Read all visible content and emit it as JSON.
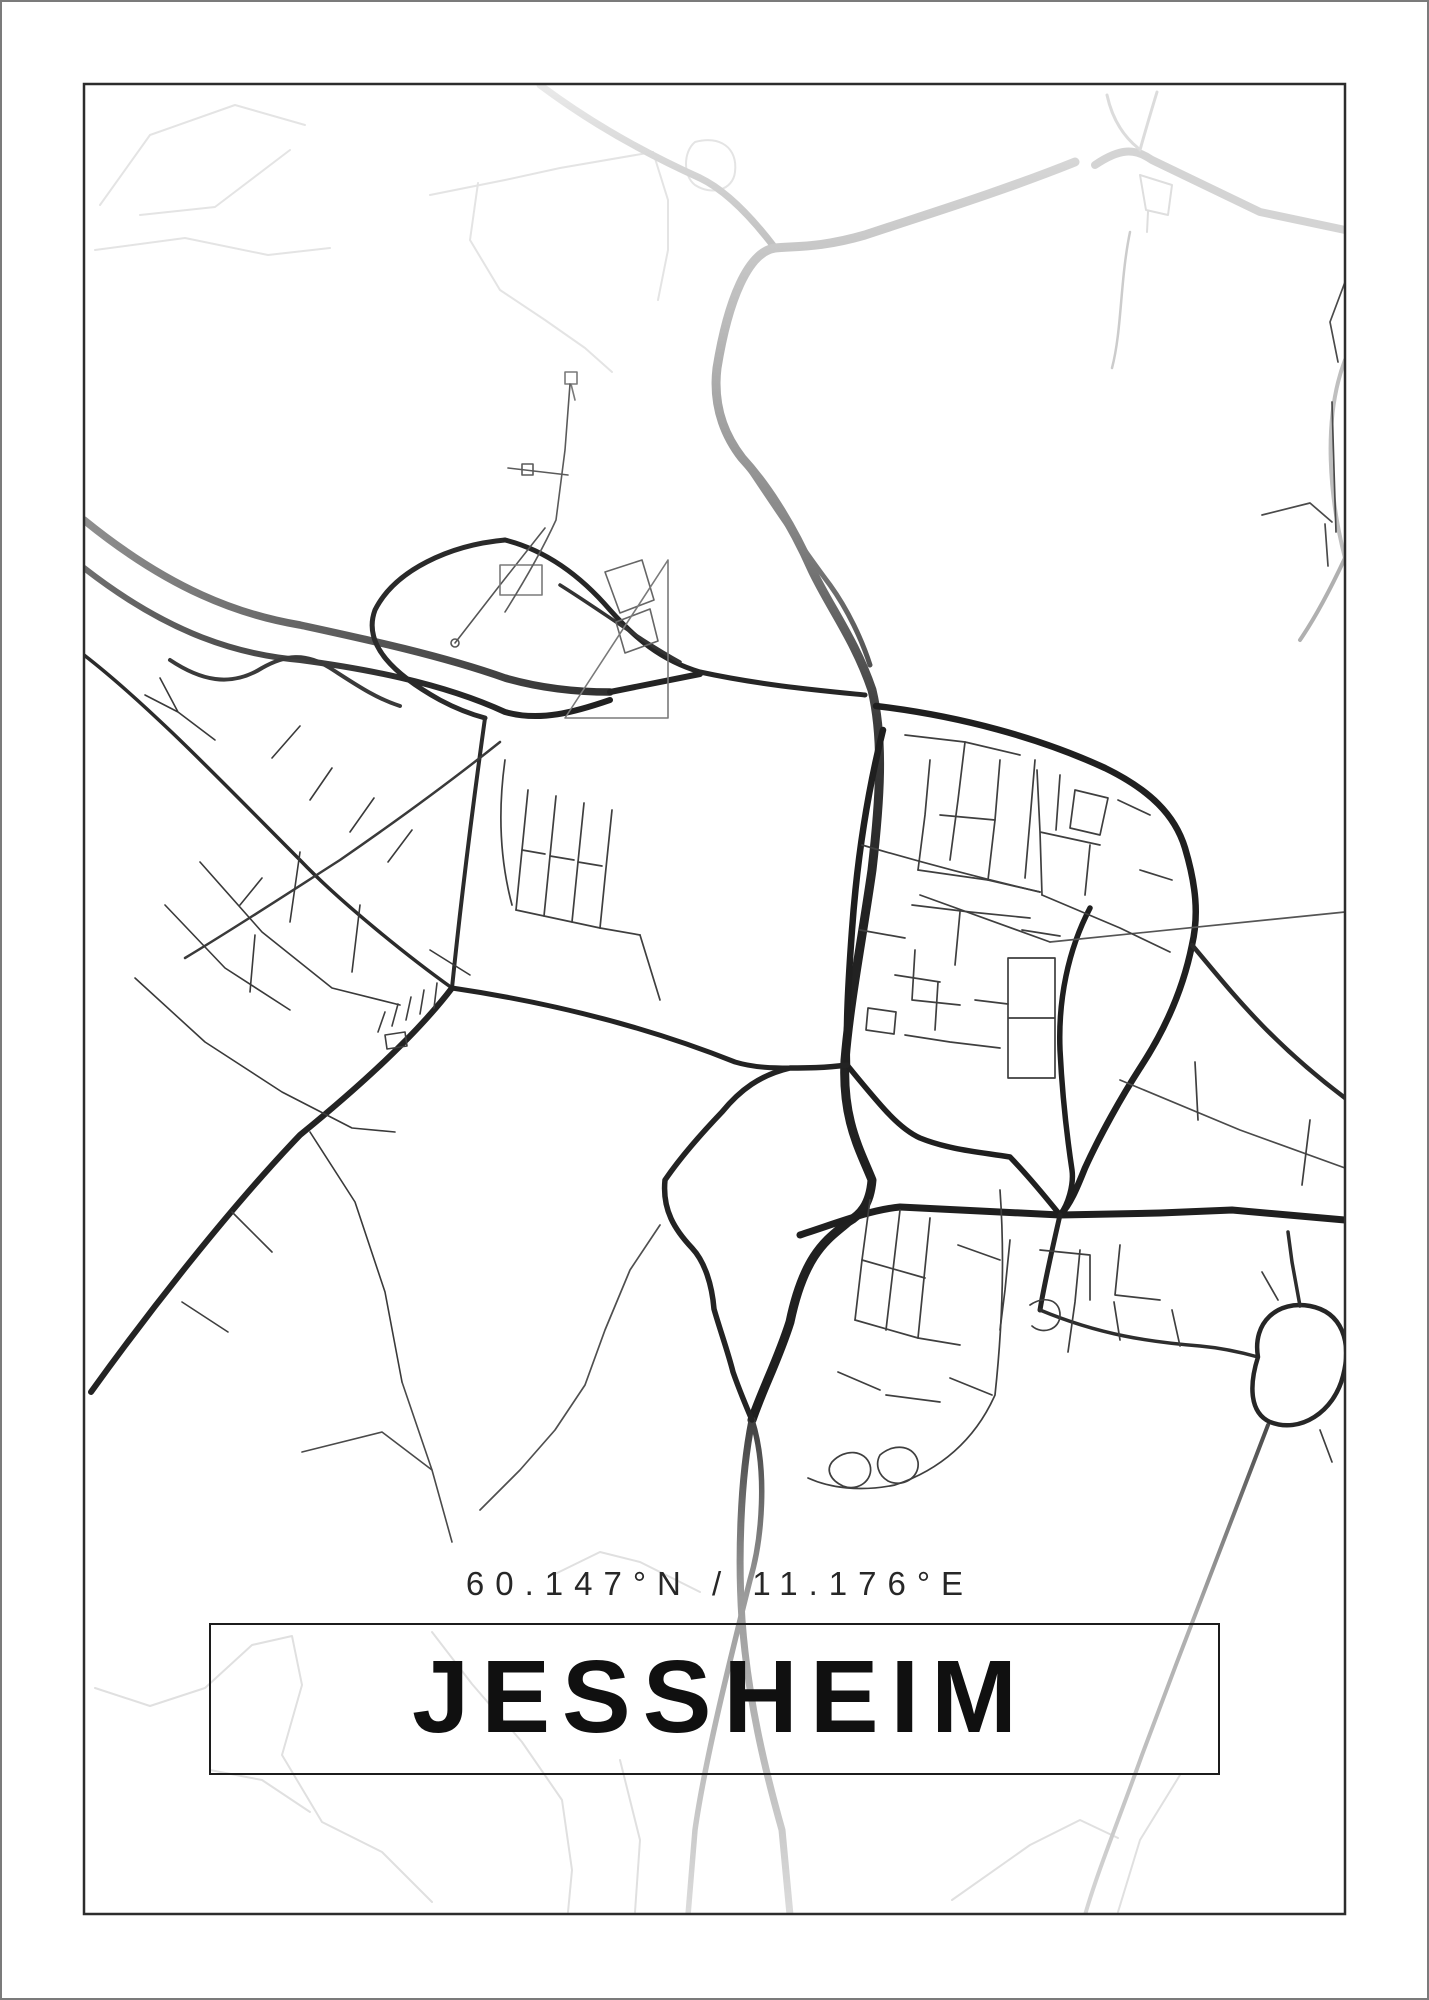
{
  "poster": {
    "title": "JESSHEIM",
    "coordinates": "60.147°N / 11.176°E",
    "style": {
      "background": "#ffffff",
      "ink": "#101010",
      "frame_color": "#2c2c2c",
      "outer_edge_color": "#7b7b7b",
      "road_dark": "#1f1f1f",
      "road_gray": "#4a4a4a",
      "road_light": "#d4d4d4",
      "road_faint": "#e2e2e2"
    }
  }
}
